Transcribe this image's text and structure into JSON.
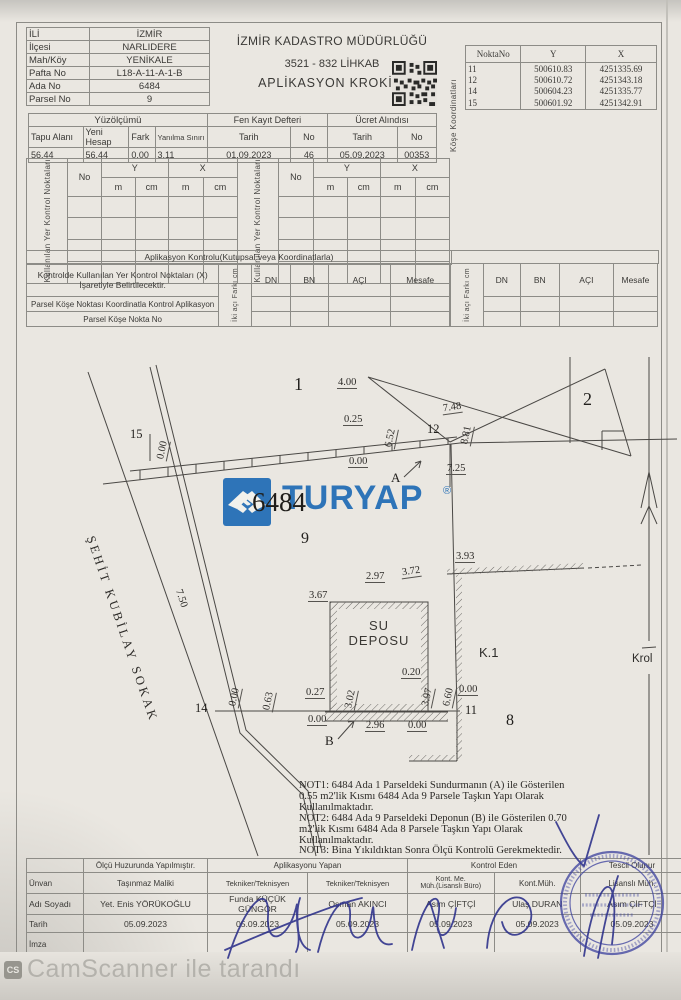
{
  "colors": {
    "turyap_blue": "#2e74b8",
    "stamp_blue": "#3a3f9e",
    "signature_blue": "#2b2f8a",
    "paper": "#eae7e1"
  },
  "footer": {
    "badge": "CS",
    "text": "CamScanner ile tarandı"
  },
  "header": {
    "location": {
      "rows": [
        {
          "l": "İLİ",
          "v": "İZMİR"
        },
        {
          "l": "İlçesi",
          "v": "NARLIDERE"
        },
        {
          "l": "Mah/Köy",
          "v": "YENİKALE"
        },
        {
          "l": "Pafta No",
          "v": "L18-A-11-A-1-B"
        },
        {
          "l": "Ada No",
          "v": "6484"
        },
        {
          "l": "Parsel No",
          "v": "9"
        }
      ]
    },
    "title": {
      "office": "İZMİR KADASTRO MÜDÜRLÜĞÜ",
      "ref": "3521 - 832 LİHKAB",
      "doc": "APLİKASYON KROKİSİ"
    },
    "coords": {
      "side": "Köşe Koordinatları",
      "h": [
        "NoktaNo",
        "Y",
        "X"
      ],
      "rows": [
        [
          "11",
          "500610.83",
          "4251335.69"
        ],
        [
          "12",
          "500610.72",
          "4251343.18"
        ],
        [
          "14",
          "500604.23",
          "4251335.77"
        ],
        [
          "15",
          "500601.92",
          "4251342.91"
        ]
      ]
    }
  },
  "area": {
    "title": "Yüzölçümü",
    "c1": "Tapu Alanı",
    "c2": "Yeni Hesap",
    "c3": "Fark",
    "c4": "Yanılma Sınırı",
    "v1": "56.44",
    "v2": "56.44",
    "v3": "0.00",
    "v4": "3.11",
    "fen": {
      "title": "Fen Kayıt Defteri",
      "ct": "Tarih",
      "cn": "No",
      "t": "01.09.2023",
      "n": "46"
    },
    "fee": {
      "title": "Ücret Alındısı",
      "ct": "Tarih",
      "cn": "No",
      "t": "05.09.2023",
      "n": "00353"
    }
  },
  "control": {
    "side": "Kullanılan Yer Kontrol Noktaları",
    "no": "No",
    "y": "Y",
    "x": "X",
    "m": "m",
    "cm": "cm"
  },
  "apl": {
    "title": "Aplikasyon Kontrolu(Kutupsal veya Koordinatlarla)",
    "n1a": "Kontrolde Kullanılan Yer Kontrol Noktaları (X)",
    "n1b": "İşaretiyle Belirtilecektir.",
    "n2": "Parsel Köşe Noktası Koordinatla Kontrol Aplikasyon",
    "n3": "Parsel Köşe Nokta No",
    "side": "İki açı Farkı cm",
    "side2": "İki açı Farkı cm",
    "dn": "DN",
    "bn": "BN",
    "aci": "AÇI",
    "mes": "Mesafe"
  },
  "sketch": {
    "p1": "1",
    "p2": "2",
    "p8": "8",
    "p9": "9",
    "ada": "6484",
    "n11": "11",
    "n12": "12",
    "n14": "14",
    "n15": "15",
    "a": "A",
    "b": "B",
    "k1": "K.1",
    "krol": "Krol",
    "depo1": "SU",
    "depo2": "DEPOSU",
    "street": "ŞEHİT KUBİLAY SOKAK",
    "m": {
      "m1": "4.00",
      "m2": "0.25",
      "m3": "6.52",
      "m4": "7.48",
      "m5": "8.81",
      "m6": "0.00",
      "m7": "7.25",
      "m8": "0.00",
      "m9": "3.93",
      "m10": "2.97",
      "m11": "3.72",
      "m12": "3.67",
      "m13": "0.20",
      "m14": "3.97",
      "m15": "6.60",
      "m16": "0.00",
      "m17": "0.27",
      "m18": "3.02",
      "m19": "0.00",
      "m20": "0.63",
      "m21": "0.00",
      "m22": "2.96",
      "m23": "0.00",
      "m24": "7.50"
    }
  },
  "brand": {
    "name": "TURYAP",
    "reg": "®"
  },
  "notes": {
    "l1": "NOT1: 6484 Ada 1 Parseldeki Sundurmanın (A) ile Gösterilen",
    "l2": "0.55 m2'lik Kısmı 6484 Ada 9 Parsele Taşkın Yapı Olarak",
    "l3": "Kullanılmaktadır.",
    "l4": "NOT2: 6484 Ada 9 Parseldeki Deponun (B) ile Gösterilen 0.70",
    "l5": "m2'lik Kısmı 6484 Ada 8 Parsele Taşkın Yapı Olarak",
    "l6": "Kullanılmaktadır.",
    "l7": "NOT3: Bina Yıkıldıktan Sonra Ölçü Kontrolü Gerekmektedir."
  },
  "sig": {
    "rl1": "Ünvan",
    "rl2": "Adı Soyadı",
    "rl3": "Tarih",
    "rl4": "İmza",
    "h1": "Ölçü Huzurunda Yapılmıştır.",
    "h2": "Aplikasyonu Yapan",
    "h3": "Kontrol Eden",
    "h4": "Tescil Olunur",
    "u1": "Taşınmaz Maliki",
    "u2": "Tekniker/Teknisyen",
    "u3": "Tekniker/Teknisyen",
    "u4": "Kont. Me.\nMüh.(Lisanslı Büro)",
    "u5": "Kont.Müh.",
    "u6": "Lisanslı Müh.",
    "n1": "Yet. Enis YÖRÜKOĞLU",
    "n2": "Funda KÜÇÜK GÜNGÖR",
    "n3": "Osman AKINCI",
    "n4": "Asım ÇİFTÇİ",
    "n5": "Ulaş DURAN",
    "n6": "Asım ÇİFTÇİ",
    "d1": "05.09.2023",
    "d2": "05.09.2023",
    "d3": "05.09.2023",
    "d4": "05.09.2023",
    "d5": "05.09.2023",
    "d6": "05.09.2023"
  }
}
